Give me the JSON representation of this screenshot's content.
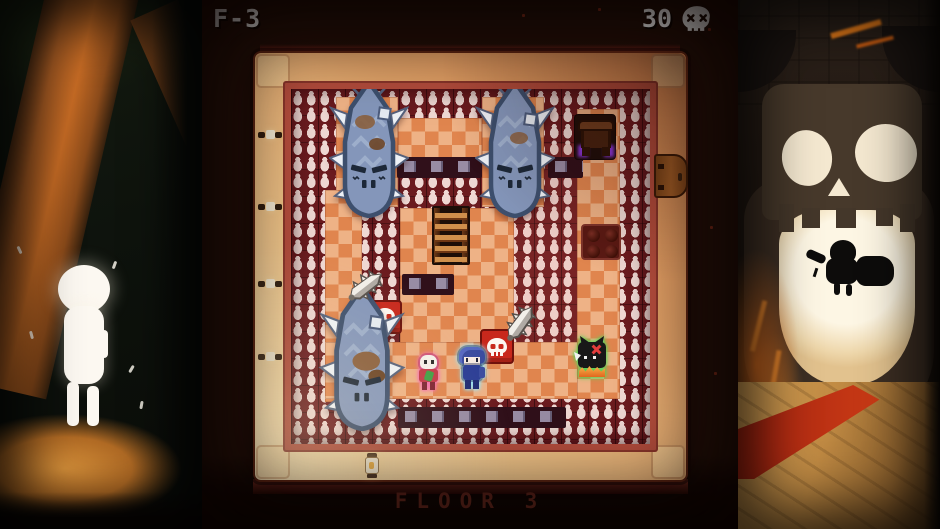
{
  "hud": {
    "floor_code": "F-3",
    "skull_count": "30",
    "skull_icon": "skull-icon"
  },
  "footer": {
    "floor_title": "FLOOR 3"
  },
  "board": {
    "entities": [
      "spiked-golem (x3)",
      "ladder",
      "altar-table",
      "side-door",
      "pressure-plate",
      "skull-tile (x2)",
      "spiked-club (x2)",
      "player-bluehair",
      "skeleton-imp",
      "cat-spirit",
      "wall-candles",
      "wall-sconce (x4)",
      "lantern"
    ]
  },
  "panels": {
    "left_scene": "forest-child-spirit",
    "right_scene": "skull-monument"
  },
  "colors": {
    "viewport_bg": "#241009",
    "frame_light": "#f8e4b8",
    "frame_dark": "#d8864e",
    "wall_maroon": "#6b1b1f",
    "candle_white": "#efd8d3",
    "floor_tan": "#eeb286",
    "floor_orange": "#e0854e",
    "golem_blue": "#8496ba",
    "skull_tile_red": "#c8281c",
    "player_glow": "#96e4f8",
    "skeleton_glow": "#f46ab2",
    "cat_glow": "#55d455",
    "hud_text": "#f2f2f2",
    "floor_title_color": "#702b20"
  }
}
